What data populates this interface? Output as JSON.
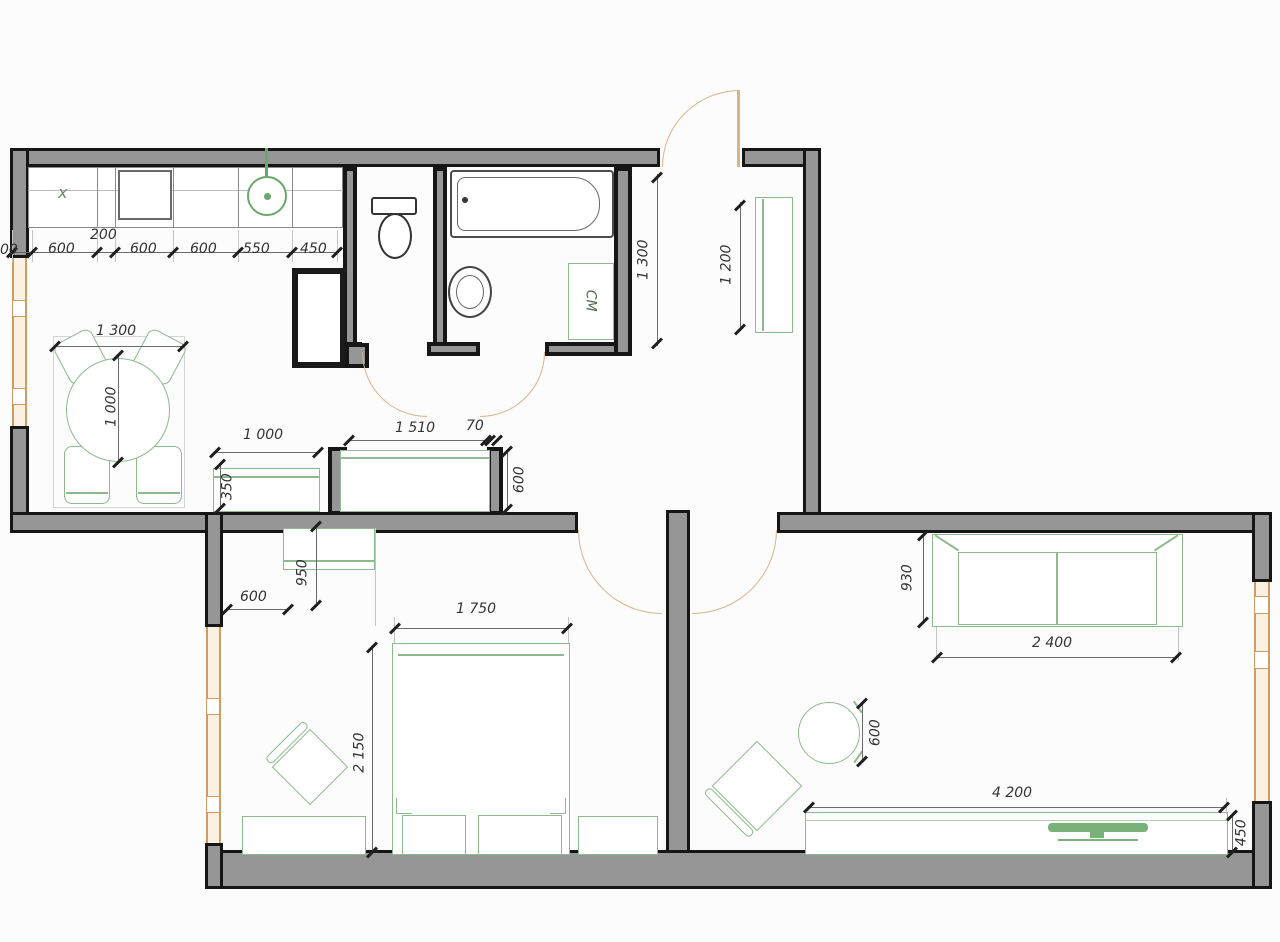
{
  "drawing": {
    "type": "apartment floor plan",
    "colors": {
      "wall_fill": "#969696",
      "wall_stroke": "#161616",
      "furniture_green": "#8cba8c",
      "door_arc": "#d8b488",
      "window_frame": "#cf9d64",
      "dim_text": "#333333",
      "background": "#fcfcfc"
    },
    "kitchen": {
      "hob_mark": "x",
      "dim_left_partial": "00",
      "counter_dims": {
        "d1": "600",
        "d2": "200",
        "d3": "600",
        "d4": "600",
        "d5": "550",
        "d6": "450"
      }
    },
    "dining": {
      "table_width": "1 300",
      "table_depth": "1 000",
      "shelf_width": "1 000",
      "shelf_depth": "350"
    },
    "hall_unit": {
      "width": "1 510",
      "partition": "70",
      "depth": "600"
    },
    "hallway": {
      "length": "1 300",
      "wardrobe_length": "1 200"
    },
    "bathroom": {
      "washing_machine_label": "СМ"
    },
    "bedroom": {
      "closet_width": "600",
      "closet_depth": "950",
      "bed_width": "1 750",
      "bed_length": "2 150"
    },
    "living_room": {
      "sofa_depth": "930",
      "sofa_width": "2 400",
      "chair_diameter": "600",
      "tv_unit_width": "4 200",
      "tv_unit_depth": "450"
    }
  }
}
